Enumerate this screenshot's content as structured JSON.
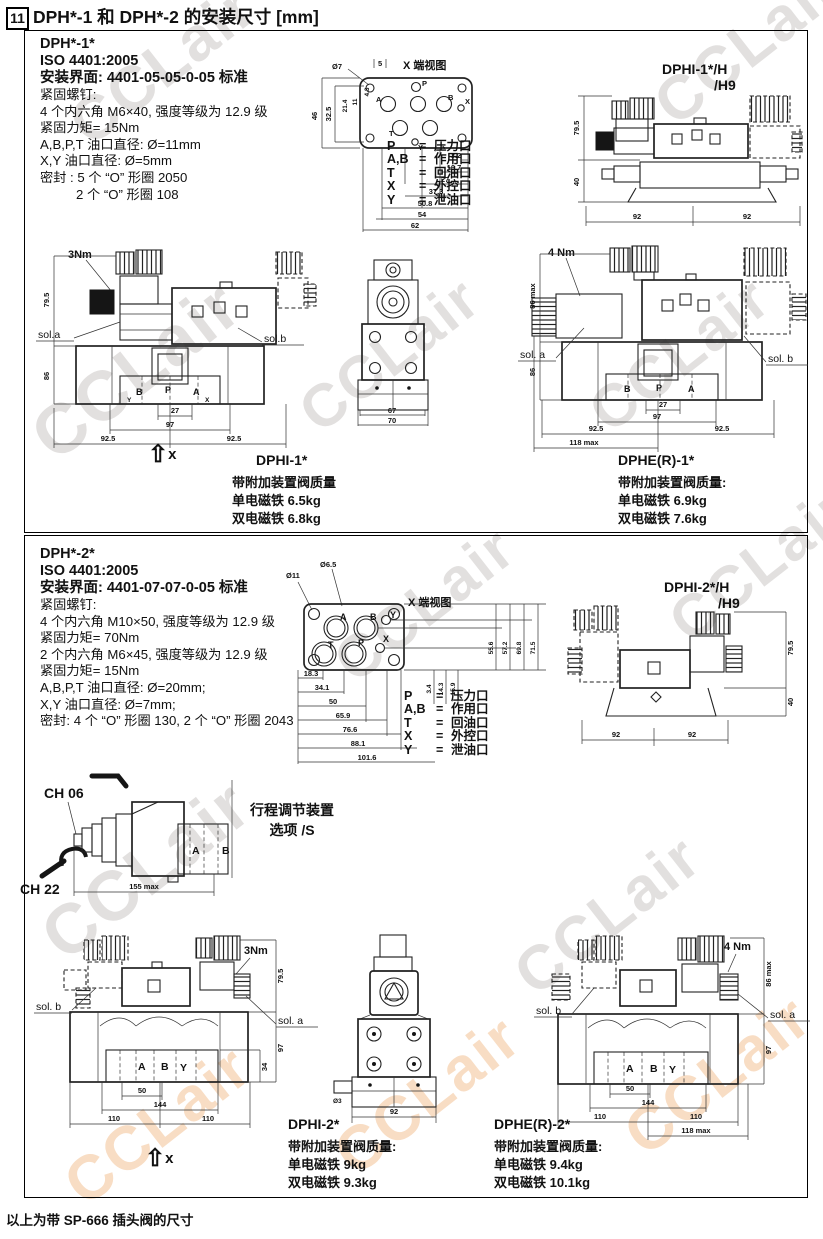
{
  "page": {
    "number": "11",
    "title": "DPH*-1 和 DPH*-2 的安装尺寸 [mm]",
    "footer": "以上为带 SP-666 插头阀的尺寸",
    "watermark": "CCLair"
  },
  "legend": {
    "eq": "=",
    "p": {
      "k": "P",
      "v": "压力口"
    },
    "ab": {
      "k": "A,B",
      "v": "作用口"
    },
    "t": {
      "k": "T",
      "v": "回油口"
    },
    "x": {
      "k": "X",
      "v": "外控口"
    },
    "y": {
      "k": "Y",
      "v": "泄油口"
    }
  },
  "s1": {
    "model": "DPH*-1*",
    "iso": "ISO 4401:2005",
    "mount": "安装界面: 4401-05-05-0-05 标准",
    "specs": [
      "紧固螺钉:",
      "4 个内六角 M6×40, 强度等级为 12.9 级",
      "紧固力矩= 15Nm",
      "A,B,P,T 油口直径: Ø=11mm",
      "X,Y 油口直径: Ø=5mm",
      "密封 : 5 个 “O” 形圈 2050",
      "2 个 “O” 形圈 108"
    ],
    "end_view": "X 端视图",
    "iface": {
      "hole": "Ø7",
      "top": "5",
      "v1": "46",
      "v2": "32.5",
      "v3": "21.4",
      "v4": "11",
      "v5": "4.3",
      "ladder": [
        "3.2",
        "16.7",
        "27",
        "37.3",
        "50.8",
        "54",
        "62"
      ],
      "ports": {
        "p": "P",
        "a": "A",
        "b": "B",
        "t": "T",
        "x": "X",
        "y": "Y"
      }
    },
    "dphih": {
      "t1": "DPHI-1*/H",
      "t2": "/H9",
      "h1": "79.5",
      "h2": "40",
      "w1": "92",
      "w2": "92"
    },
    "front": {
      "torque": "3Nm",
      "sola": "sol.a",
      "solb": "sol.b",
      "h1": "79.5",
      "h2": "86",
      "d27": "27",
      "d97": "97",
      "dl": "92.5",
      "dr": "92.5",
      "pb": "B",
      "pp": "P",
      "pa": "A",
      "py": "Y",
      "px": "X"
    },
    "xarrow": "x",
    "side": {
      "d67": "67",
      "d70": "70"
    },
    "dphi_label": "DPHI-1*",
    "dphi_w": [
      "带附加装置阀质量",
      "单电磁铁 6.5kg",
      "双电磁铁 6.8kg"
    ],
    "dphe": {
      "torque": "4 Nm",
      "hmax": "86 max",
      "h86": "86",
      "sola": "sol. a",
      "solb": "sol. b",
      "d27": "27",
      "d97": "97",
      "dl": "92.5",
      "dr": "92.5",
      "dmax": "118 max",
      "pb": "B",
      "pp": "P",
      "pa": "A"
    },
    "dphe_label": "DPHE(R)-1*",
    "dphe_w": [
      "带附加装置阀质量:",
      "单电磁铁 6.9kg",
      "双电磁铁 7.6kg"
    ]
  },
  "s2": {
    "model": "DPH*-2*",
    "iso": "ISO 4401:2005",
    "mount": "安装界面: 4401-07-07-0-05 标准",
    "specs": [
      "紧固螺钉:",
      "4 个内六角 M10×50, 强度等级为 12.9 级",
      "紧固力矩= 70Nm",
      "2 个内六角 M6×45, 强度等级为 12.9 级",
      "紧固力矩= 15Nm",
      "A,B,P,T 油口直径: Ø=20mm;",
      "X,Y 油口直径: Ø=7mm;",
      "密封: 4 个 “O” 形圈 130, 2 个 “O” 形圈 2043"
    ],
    "end_view": "X 端视图",
    "iface": {
      "hole1": "Ø11",
      "hole2": "Ø6.5",
      "right": [
        "55.6",
        "57.2",
        "69.8",
        "71.5"
      ],
      "small": [
        "3.4",
        "14.3",
        "15.9"
      ],
      "ladder": [
        "18.3",
        "34.1",
        "50",
        "65.9",
        "76.6",
        "88.1",
        "101.6"
      ],
      "ports": {
        "a": "A",
        "b": "B",
        "y": "Y",
        "t": "T",
        "p": "P",
        "x": "X"
      }
    },
    "dphih": {
      "t1": "DPHI-2*/H",
      "t2": "/H9",
      "h1": "79.5",
      "h2": "40",
      "w1": "92",
      "w2": "92"
    },
    "adj": {
      "ch06": "CH 06",
      "ch22": "CH 22",
      "dim": "155 max",
      "pa": "A",
      "pb": "B",
      "opt1": "行程调节装置",
      "opt2": "选项 /S"
    },
    "front": {
      "torque": "3Nm",
      "sola": "sol. a",
      "solb": "sol. b",
      "h1": "79.5",
      "h2": "97",
      "h3": "34",
      "pa": "A",
      "pb": "B",
      "py": "Y",
      "d50": "50",
      "d144": "144",
      "dl": "110",
      "dr": "110"
    },
    "xarrow": "x",
    "side": {
      "d92": "92",
      "hole": "Ø3"
    },
    "dphi_label": "DPHI-2*",
    "dphi_w": [
      "带附加装置阀质量:",
      "单电磁铁 9kg",
      "双电磁铁 9.3kg"
    ],
    "dphe": {
      "torque": "4 Nm",
      "hmax": "86 max",
      "h97": "97",
      "sola": "sol. a",
      "solb": "sol. b",
      "pa": "A",
      "pb": "B",
      "py": "Y",
      "d50": "50",
      "d144": "144",
      "dl": "110",
      "dr": "110",
      "dmax": "118 max"
    },
    "dphe_label": "DPHE(R)-2*",
    "dphe_w": [
      "带附加装置阀质量:",
      "单电磁铁 9.4kg",
      "双电磁铁 10.1kg"
    ]
  }
}
